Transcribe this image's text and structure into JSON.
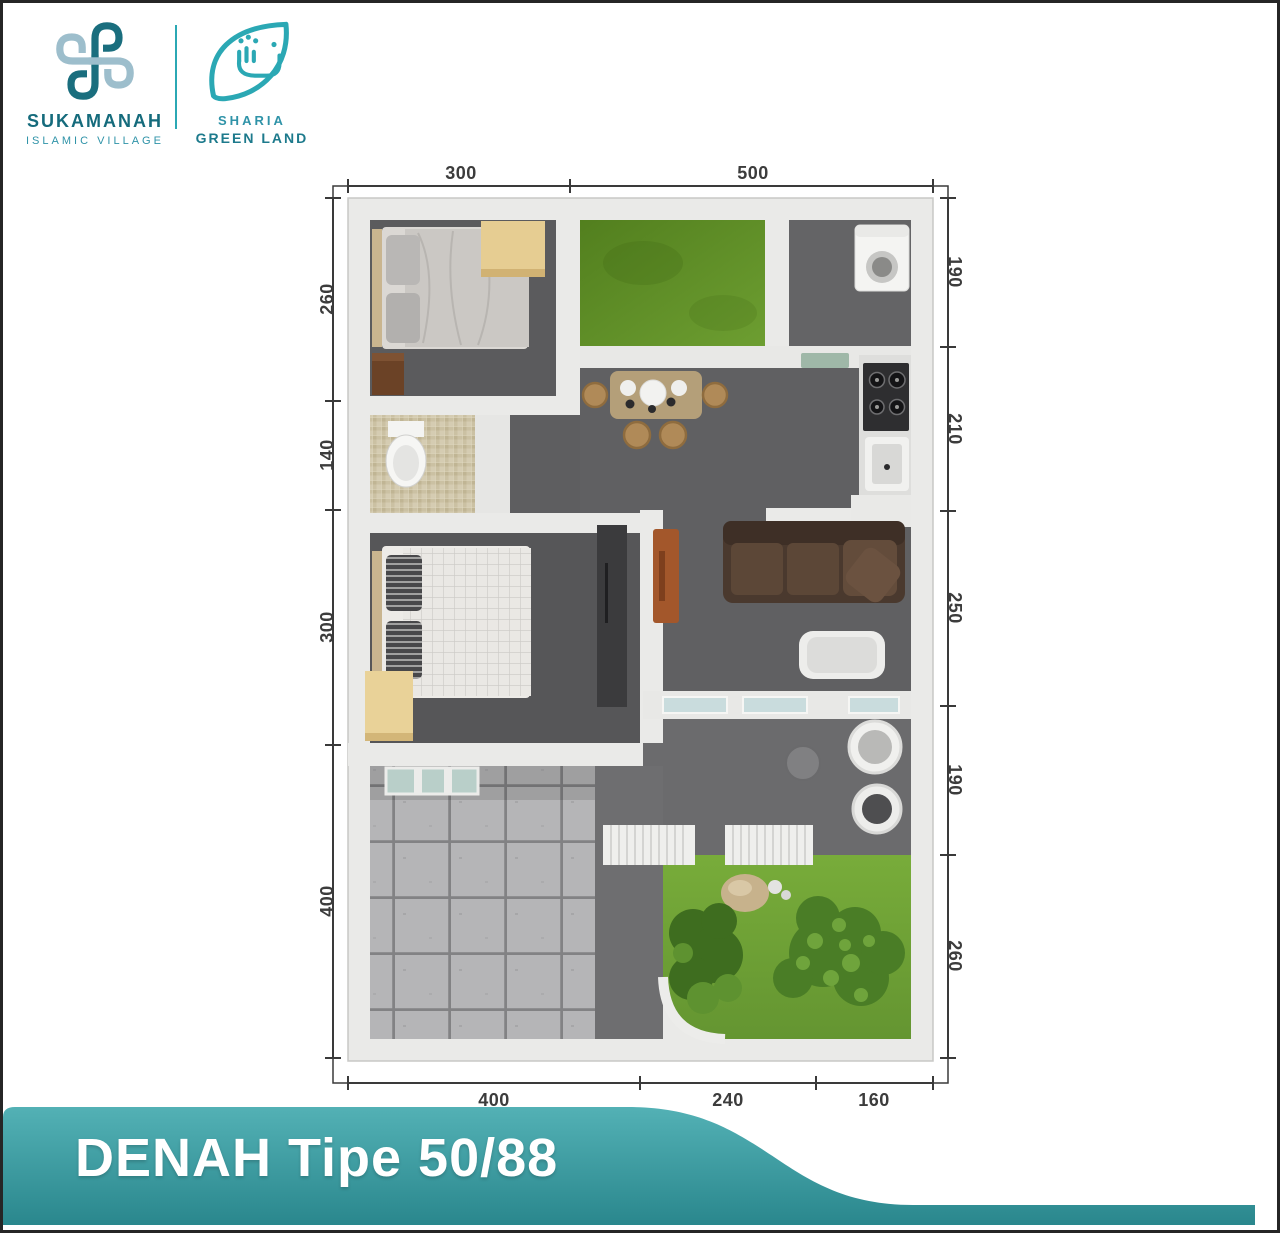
{
  "brand": {
    "sukamanah": {
      "name": "SUKAMANAH",
      "tagline": "ISLAMIC VILLAGE"
    },
    "sharia": {
      "line1": "SHARIA",
      "line2": "GREEN LAND"
    }
  },
  "plan": {
    "dim_top": [
      "300",
      "500"
    ],
    "dim_left": [
      "260",
      "140",
      "300",
      "400"
    ],
    "dim_right": [
      "190",
      "210",
      "250",
      "190",
      "260"
    ],
    "dim_bottom": [
      "400",
      "240",
      "160"
    ]
  },
  "footer": {
    "title": "DENAH Tipe 50/88"
  },
  "colors": {
    "teal": "#2BA8B4",
    "teal_dark": "#17697A",
    "banner_top": "#53B1B5",
    "banner_bottom": "#2A878D",
    "grass": "#6FA436",
    "floor_dark": "#59595B",
    "wall": "#E9E9E7",
    "dimension_text": "#3C3C3C"
  }
}
